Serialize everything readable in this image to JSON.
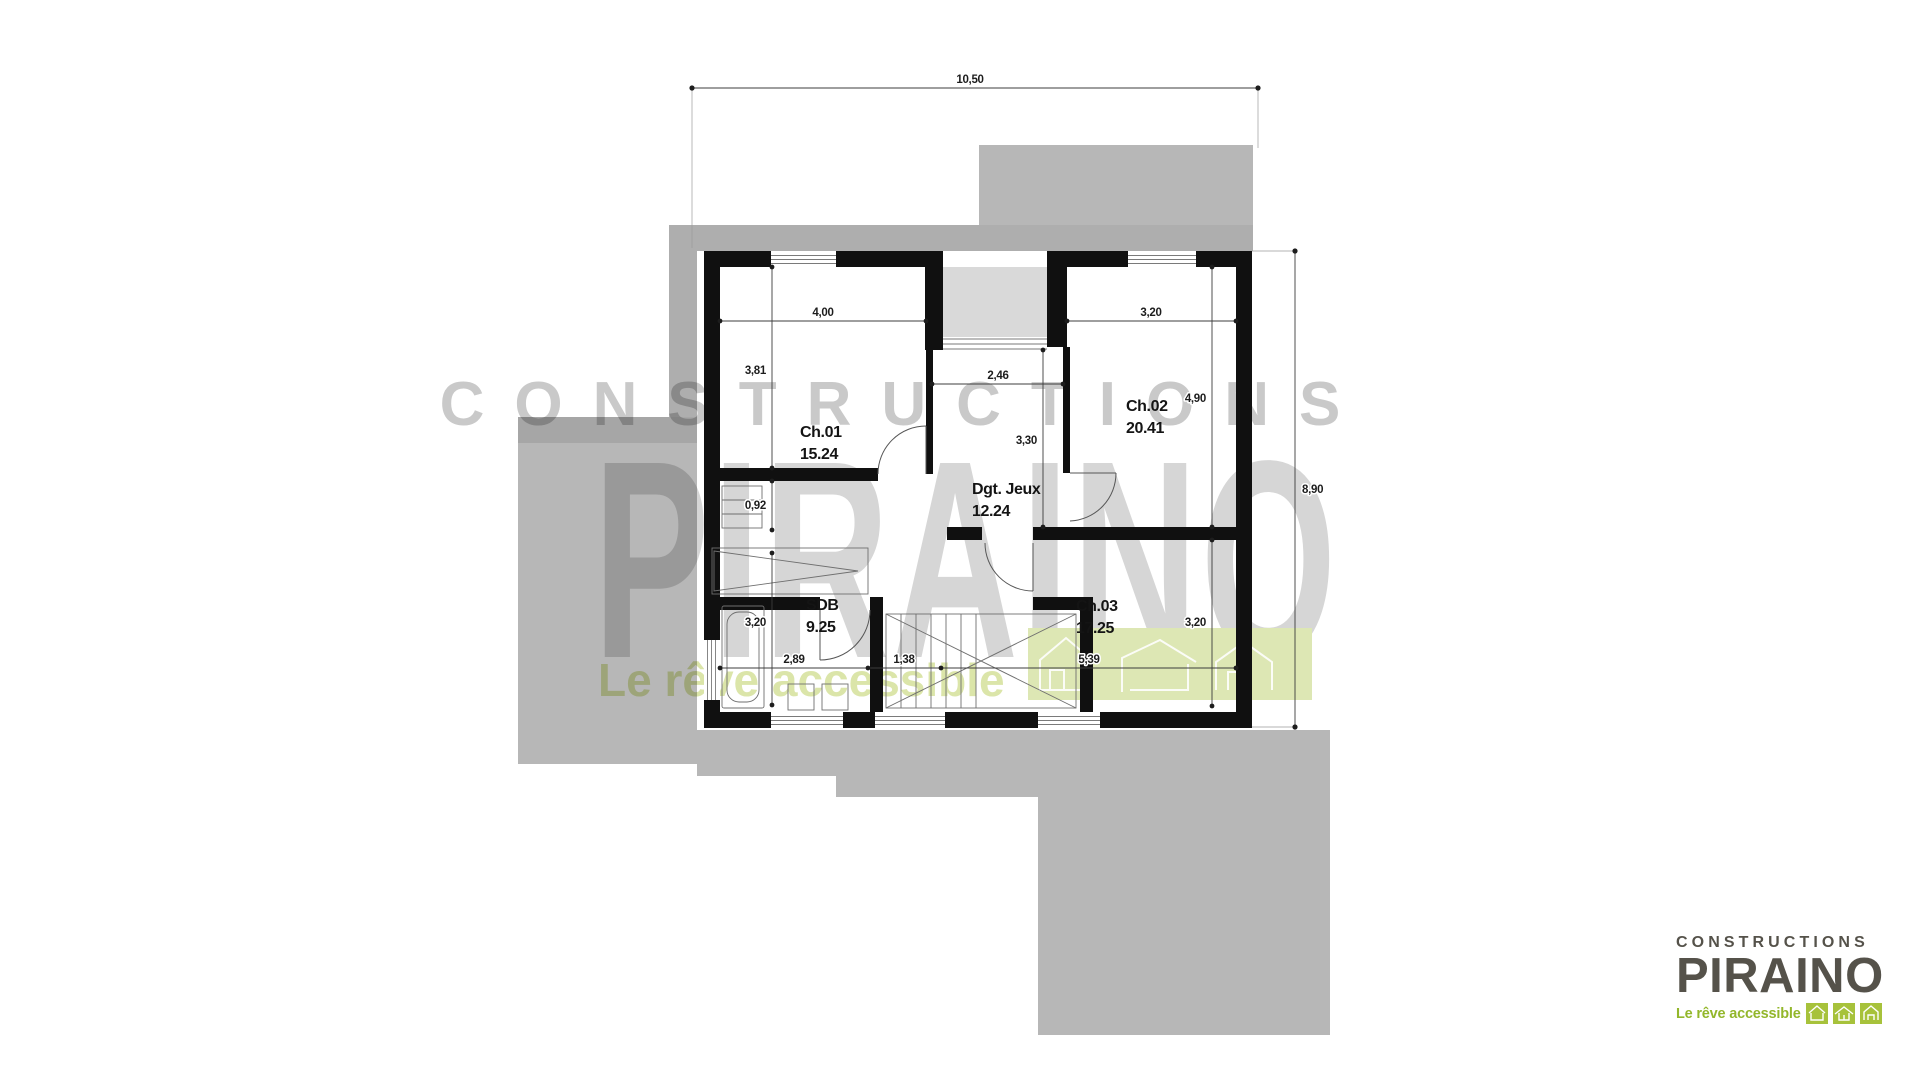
{
  "watermark": {
    "brand_top": "CONSTRUCTIONS",
    "brand_main": "PIRAINO",
    "tagline": "Le rêve accessible"
  },
  "logo": {
    "brand_top": "CONSTRUCTIONS",
    "brand_main": "PIRAINO",
    "tagline": "Le rêve accessible"
  },
  "floor_plan": {
    "rooms": [
      {
        "id": "ch01",
        "name": "Ch.01",
        "area": "15.24"
      },
      {
        "id": "ch02",
        "name": "Ch.02",
        "area": "20.41"
      },
      {
        "id": "degagement-jeux",
        "name": "Dgt. Jeux",
        "area": "12.24"
      },
      {
        "id": "sdb",
        "name": "SDB",
        "area": "9.25"
      },
      {
        "id": "ch03",
        "name": "Ch.03",
        "area": "17.25"
      }
    ],
    "dims": {
      "total_width": "10,50",
      "total_height": "8,90",
      "ch01_w": "4,00",
      "ch01_h": "3,81",
      "closet_h": "0,92",
      "sdb_h": "3,20",
      "niche_w": "2,46",
      "landing_h": "3,30",
      "ch02_w": "3,20",
      "ch02_h": "4,90",
      "ch03_h": "3,20",
      "sdb_w": "2,89",
      "stair_w": "1,38",
      "ch03_w": "5,39"
    },
    "colors": {
      "roof_gray": "#b7b7b7",
      "roof_dark": "#aeaeae",
      "terrace_light": "#d9d9d9",
      "wall_black": "#101010",
      "brand_green": "#93b72b",
      "watermark_green": "#dbe5a9"
    }
  }
}
